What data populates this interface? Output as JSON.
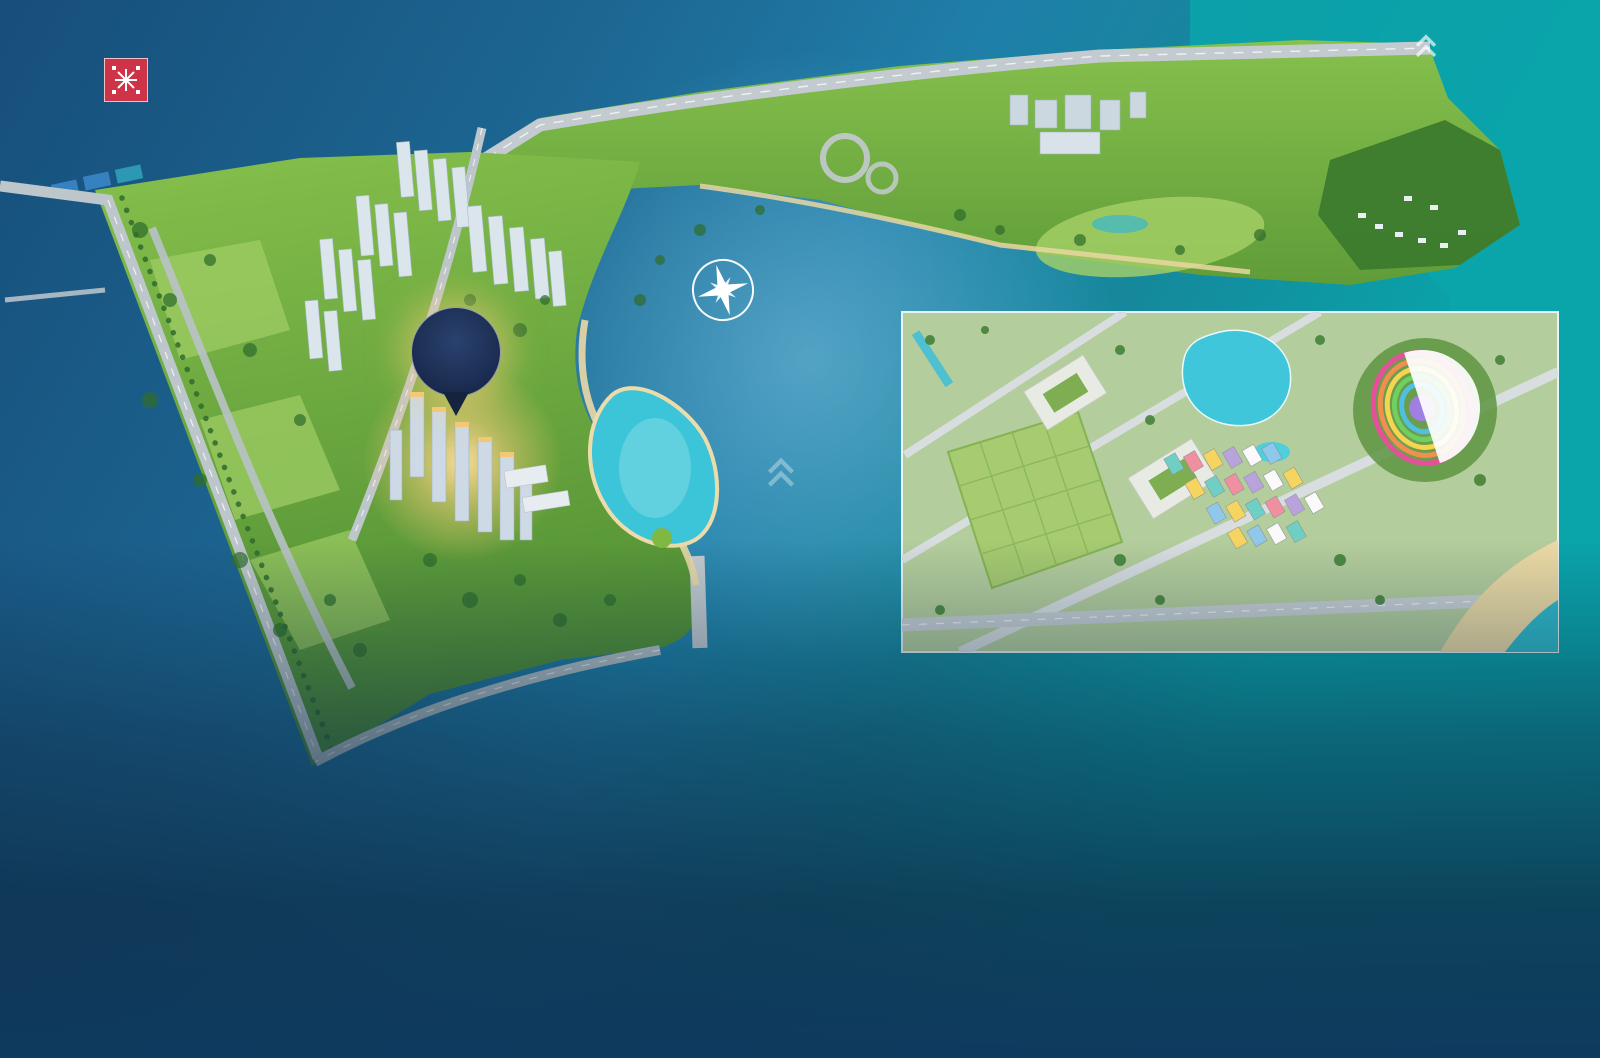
{
  "header": {
    "developer": {
      "name": "MIKGROUP",
      "tagline": "ĐƠN VỊ PHÁT TRIỂN DỰ ÁN"
    },
    "brand": {
      "name": "Batdongsan",
      "domain": ".com.vn",
      "byline": "by PropertyGuru"
    },
    "direction": {
      "line1": "TRUNG TÂM",
      "line2": "HÀ NỘI →"
    }
  },
  "map": {
    "project_pin": {
      "crown": "♛",
      "line1": "IMPERIA",
      "line2": "SMART CITY"
    },
    "compass": {
      "n": "B",
      "e": "Đ",
      "s": "N",
      "w": "T"
    },
    "pills": [
      {
        "text": "SAPPHIRE 1",
        "x": 437,
        "y": 166
      },
      {
        "text": "SAPPHIRE 2",
        "x": 416,
        "y": 207
      },
      {
        "text": "THE MIAMI",
        "x": 376,
        "y": 239
      },
      {
        "text": "THE SAKURA",
        "x": 357,
        "y": 289
      },
      {
        "text": "SAPPHIRE PARKVILLE",
        "x": 507,
        "y": 247
      },
      {
        "text": "MASTERI WEST HEIGHT",
        "x": 557,
        "y": 489,
        "rot": -3
      },
      {
        "text": "TONKIN",
        "x": 531,
        "y": 513,
        "rot": -3
      }
    ],
    "road_labels": [
      {
        "text": "TUYẾN METRO SỐ 5",
        "x": 603,
        "y": 132,
        "rot": -9,
        "size": 10
      },
      {
        "text": "TUYẾN METRO SỐ 6",
        "x": 429,
        "y": 292,
        "rot": 77,
        "size": 10
      },
      {
        "text": "TUYẾN METRO SỐ 7",
        "x": 146,
        "y": 272,
        "rot": 70,
        "size": 10
      },
      {
        "text": "ĐƯỜNG LÊ TRỌNG TẤN",
        "x": 218,
        "y": 468,
        "rot": 71,
        "size": 10
      },
      {
        "text": "CẦU VƯỢT ĐƯỜNG LÊ TRỌNG TẤN",
        "x": 328,
        "y": 524,
        "rot": -16,
        "size": 9,
        "color": "#8fd6f2"
      },
      {
        "text": "ĐƯỜNG 72",
        "x": 413,
        "y": 706,
        "rot": -32,
        "size": 11
      },
      {
        "text": "ĐẠI LỘ THĂNG LONG",
        "x": 912,
        "y": 97,
        "rot": -3,
        "size": 15
      }
    ],
    "area_labels": [
      {
        "lines": [
          "CÔNG VIÊN",
          "SPORTIA PARK"
        ],
        "x": 630,
        "y": 296,
        "rot": -6,
        "color": "#ffffff",
        "size": 10
      },
      {
        "lines": [
          "CÔNG VIÊN",
          "CENTRAL PARK"
        ],
        "x": 658,
        "y": 466,
        "rot": -7,
        "color": "#0d97a6",
        "size": 11
      },
      {
        "lines": [
          "CÔNG VIÊN ZEN PARK"
        ],
        "x": 1114,
        "y": 233,
        "rot": -2,
        "color": "#ef3f98",
        "size": 11
      },
      {
        "lines": [
          "AEON MALL HÀ ĐÔNG"
        ],
        "x": 754,
        "y": 643,
        "rot": 0,
        "color": "#17396b",
        "size": 13
      }
    ],
    "outline_pills": [
      {
        "text": "VINHOMES GREEN VILLAS",
        "x": 1385,
        "y": 226
      }
    ],
    "light_pills": [
      {
        "text": "GA METRO",
        "x": 960,
        "y": 374
      },
      {
        "text": "TRƯỜNG VINSCHOOL",
        "x": 1088,
        "y": 421
      },
      {
        "text": "NHÀ XE & TTTM 10 TẦNG",
        "x": 1000,
        "y": 496
      },
      {
        "text": "CENTRAL PARK 10,2ha",
        "x": 1484,
        "y": 404
      }
    ],
    "balloons": [
      {
        "text": "VINMEC",
        "x": 790,
        "y": 66,
        "color": "#a9893c"
      },
      {
        "text": "VINCOM",
        "x": 1030,
        "y": 62,
        "color": "#c8102e"
      }
    ],
    "badges": [
      {
        "text": "VINSCHOOL",
        "x": 411,
        "y": 374
      },
      {
        "text": "TH SCHOOL",
        "x": 315,
        "y": 346
      }
    ],
    "icons": [
      {
        "t": "train",
        "c": "#d94545",
        "x": 487,
        "y": 119
      },
      {
        "t": "train",
        "c": "#e0368c",
        "x": 535,
        "y": 96
      },
      {
        "t": "train",
        "c": "#e0368c",
        "x": 602,
        "y": 144
      },
      {
        "t": "train",
        "c": "#e0368c",
        "x": 885,
        "y": 132
      },
      {
        "t": "train",
        "c": "#e0368c",
        "x": 1018,
        "y": 148
      },
      {
        "t": "parking",
        "c": "#18a79c",
        "x": 519,
        "y": 160
      },
      {
        "t": "parking",
        "c": "#18a79c",
        "x": 886,
        "y": 167
      },
      {
        "t": "parking",
        "c": "#18a79c",
        "x": 962,
        "y": 130
      },
      {
        "t": "parking",
        "c": "#18a79c",
        "x": 560,
        "y": 347
      },
      {
        "t": "parking",
        "c": "#18a79c",
        "x": 294,
        "y": 437
      },
      {
        "t": "parking",
        "c": "#18a79c",
        "x": 384,
        "y": 468
      },
      {
        "t": "parking",
        "c": "#18a79c",
        "x": 719,
        "y": 521
      },
      {
        "t": "parking",
        "c": "#18a79c",
        "x": 1345,
        "y": 260
      },
      {
        "t": "school",
        "c": "#2b7cc9",
        "x": 312,
        "y": 227
      },
      {
        "t": "school",
        "c": "#2b7cc9",
        "x": 280,
        "y": 312
      },
      {
        "t": "school",
        "c": "#2b7cc9",
        "x": 570,
        "y": 230
      },
      {
        "t": "school",
        "c": "#2b7cc9",
        "x": 734,
        "y": 186
      },
      {
        "t": "school",
        "c": "#2b7cc9",
        "x": 1235,
        "y": 200
      },
      {
        "t": "wc",
        "c": "#2c3f96",
        "x": 953,
        "y": 186
      },
      {
        "t": "wc",
        "c": "#2c3f96",
        "x": 1048,
        "y": 192
      },
      {
        "t": "wc",
        "c": "#2c3f96",
        "x": 1068,
        "y": 197
      },
      {
        "t": "wc",
        "c": "#2c3f96",
        "x": 1180,
        "y": 220
      },
      {
        "t": "wc",
        "c": "#2c3f96",
        "x": 600,
        "y": 372
      },
      {
        "t": "wc",
        "c": "#2c3f96",
        "x": 714,
        "y": 500
      },
      {
        "t": "bbq",
        "c": "#e04848",
        "x": 601,
        "y": 432
      },
      {
        "t": "bbq",
        "c": "#e04848",
        "x": 643,
        "y": 495
      },
      {
        "t": "gym",
        "c": "#f09a3c",
        "x": 571,
        "y": 348
      },
      {
        "t": "gym",
        "c": "#f09a3c",
        "x": 1036,
        "y": 188
      },
      {
        "t": "shop",
        "c": "#e8457a",
        "x": 412,
        "y": 446
      },
      {
        "t": "shop",
        "c": "#e8457a",
        "x": 451,
        "y": 503
      }
    ]
  },
  "legend": {
    "title": "BẢN ĐỒ TIỆN ÍCH",
    "col1": [
      {
        "icon": "train",
        "c": "#8a4fa8",
        "label": "Ga Depot"
      },
      {
        "icon": "train",
        "c": "#e0368c",
        "label": "Ga Metro"
      },
      {
        "icon": "shop",
        "c": "#e8457a",
        "label": "Thương mại dịch vụ"
      },
      {
        "icon": "bbq",
        "c": "#e04848",
        "label": "Khu vực BBQ"
      },
      {
        "icon": "gym",
        "c": "#f09a3c",
        "label": "Khu vực Gym"
      }
    ],
    "col2": [
      {
        "icon": "bank",
        "c": "#54ae4e",
        "label": "Trụ sở Ngân hàng Techcombank"
      },
      {
        "icon": "parking",
        "c": "#18a79c",
        "label": "Bãi đỗ xe"
      },
      {
        "icon": "school",
        "c": "#2b7cc9",
        "label": "Trường học"
      },
      {
        "icon": "wc",
        "c": "#2c3f96",
        "label": "Khu vực vệ sinh"
      }
    ]
  },
  "disclaimer": "Tư liệu và bản vẽ chỉ mang tính chất tham khảo và sẽ được Chủ đầu tư cập nhật, điều chỉnh tại mỗi thời điểm để đảm bảo tối ưu công năng tiện ích sử dụng của dự án",
  "amenities": {
    "title_prefix": "ĐẶC QUYỀN TRẢI NGHIỆM HƠN",
    "highlight": "40",
    "plus": "+",
    "title_suffix": "TIỆN ÍCH ĐẲNG CẤP TRONG NHÀ & NGOÀI TRỜI",
    "columns": [
      {
        "groups": [
          {
            "header": "KHU CHÀO ĐÓN",
            "items": [
              {
                "n": "1",
                "label": "Cửa an ninh quản lý bằng thẻ từ"
              },
              {
                "n": "2",
                "label": "Sảnh lễ tân Tòa"
              },
              {
                "n": "3",
                "label": "Hòm thư cư dân"
              },
              {
                "n": "4",
                "label": "Lối vào sảnh chính"
              }
            ]
          },
          {
            "header": "TIỆN ÍCH NGOÀI TRỜI",
            "items": [
              {
                "n": "5",
                "label": "Bể bơi người lớn"
              },
              {
                "n": "6",
                "label": "Khu tắm tráng ngoài trời"
              },
              {
                "n": "7",
                "label": "Lối vào bể bơi/ cổng kiểm soát"
              },
              {
                "n": "8",
                "label": "Đường dạo quanh bể bơi"
              },
              {
                "n": "9",
                "label": "Chòi nghỉ cảnh quan Full House Lounge"
              }
            ]
          }
        ]
      },
      {
        "groups": [
          {
            "header": "",
            "items": [
              {
                "n": "10",
                "label": "Hồ cảnh quan Moon Lake"
              },
              {
                "n": "11",
                "label": "Thảm cỏ dưỡng sinh"
              },
              {
                "n": "12",
                "label": "Vườn thiền Sonate Garden"
              },
              {
                "n": "13",
                "label": "Công viên dã ngoại Spring Park"
              },
              {
                "n": "14",
                "label": "Vườn cờ"
              },
              {
                "n": "15",
                "label": "Thảm cỏ đa năng"
              },
              {
                "n": "16",
                "label": "Vườn Star Garden"
              },
              {
                "n": "17",
                "label": "Đường dạo bộ Autumn Alley"
              },
              {
                "n": "18",
                "label": "Sân Tennis"
              },
              {
                "n": "19",
                "label": "Sân cầu lông"
              },
              {
                "n": "20",
                "label": "Sân bóng chuyền"
              },
              {
                "n": "21",
                "label": "Sân bóng rổ nửa sân"
              }
            ]
          }
        ]
      },
      {
        "groups": [
          {
            "header": "",
            "items": [
              {
                "n": "22",
                "label": "Sân bóng bàn"
              },
              {
                "n": "23",
                "label": "Sân tập bóng rổ"
              },
              {
                "n": "24",
                "label": "Quảng trường kết hợp sân tập thể dục"
              },
              {
                "n": "25",
                "label": "Quảng trường Symphony Square"
              },
              {
                "n": "26",
                "label": "Thang thoát hiểm/ lỗ mở"
              },
              {
                "n": "27",
                "label": "Sân tập gym ngoài trời"
              },
              {
                "n": "28",
                "label": "Khu vui chơi trẻ em Everland"
              },
              {
                "n": "29",
                "label": "khu vui chơi trẻ em Creative zone"
              },
              {
                "n": "30",
                "label": "Khu vui chơi trẻ em Galaxy Space"
              },
              {
                "n": "31",
                "label": "Khu vui chơi vận động liên hợp Summer space"
              },
              {
                "n": "32",
                "label": "Bể bơi trẻ em"
              }
            ]
          }
        ]
      },
      {
        "groups": [
          {
            "header": "TIỆN ÍCH TRONG NHÀ",
            "items": [
              {
                "n": "33",
                "label": "Không gian tập Yoga"
              },
              {
                "n": "34",
                "label": "Không gian relax"
              },
              {
                "n": "35",
                "label": "Business Lounge"
              },
              {
                "n": "36",
                "label": "Thư viện hiện đại"
              },
              {
                "n": "37",
                "label": "Co-working space"
              },
              {
                "n": "38",
                "label": "Phòng sinh hoạt cộng đồng"
              },
              {
                "n": "39",
                "label": "Không gian giải trí (bóng bàn, bi lắc)"
              },
              {
                "n": "40",
                "label": "Phòng tập Gym & Dance"
              },
              {
                "n": "41",
                "label": "Khu vui chơi trẻ em Discovery zone"
              }
            ]
          }
        ]
      }
    ]
  }
}
